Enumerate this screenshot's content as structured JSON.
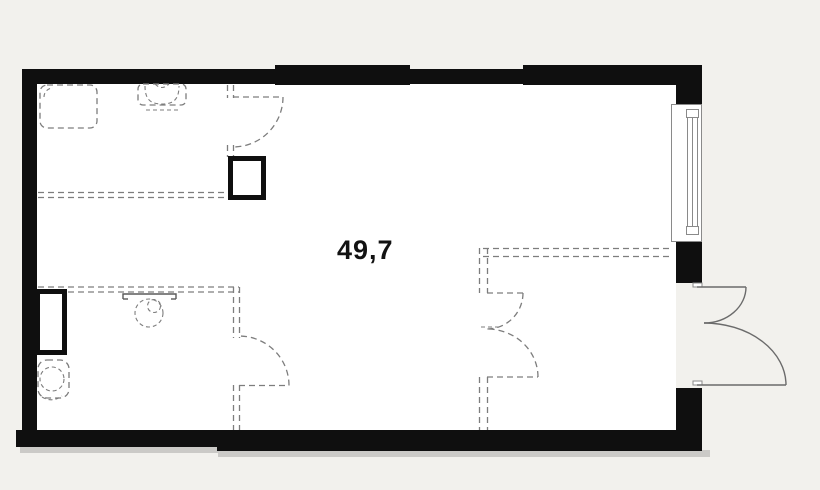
{
  "plan": {
    "area_label": "49,7"
  },
  "fixtures": [
    "washing-machine",
    "bathroom-sink-top",
    "bathroom-sink-middle",
    "toilet",
    "ventilation-shaft-top",
    "ventilation-shaft-left",
    "window-right",
    "entrance-double-door",
    "planned-door-top",
    "planned-door-middle",
    "planned-double-door-right"
  ],
  "colors": {
    "bg": "#f2f1ed",
    "wall": "#0f0f0f",
    "interior": "#ffffff",
    "dash": "#7d7d7d",
    "door": "#6b6b6b",
    "label": "#121212",
    "frame": "#8a8a8a",
    "shadow": "rgba(0,0,0,0.16)"
  }
}
